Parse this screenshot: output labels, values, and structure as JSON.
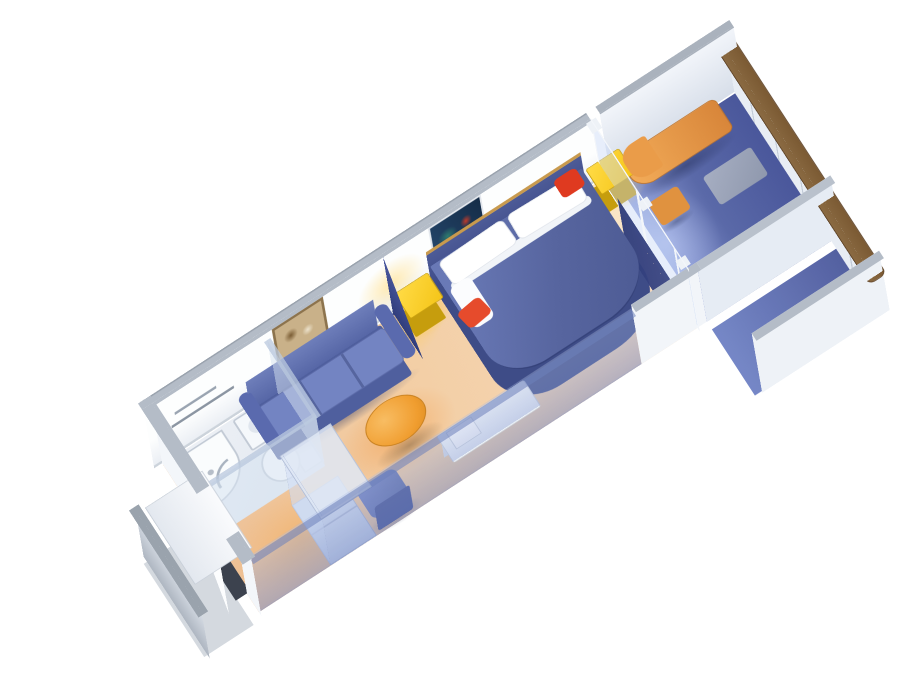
{
  "meta": {
    "scene": "Cruise ship balcony stateroom - 3D isometric cutaway floor plan",
    "view": "isometric cutaway, cabin axis running lower-left to upper-right",
    "background": "#ffffff"
  },
  "palette": {
    "floor": "#f3cfa6",
    "floorGlow": "#f3a55f",
    "wall": "#fdfefe",
    "wallCap": "#b4bcc7",
    "translucentWall": "rgba(125,145,200,0.45)",
    "deck": "#4a579b",
    "deckLight": "#8d9cd8",
    "bedTop": "#57659f",
    "bedBase": "#3e4c87",
    "sofa": "#5d6cab",
    "cushion": "#7384c2",
    "accentYellow": "#f5c519",
    "accentRed": "#e64b2c",
    "tableOrange": "#f09d2f",
    "loungerOrange": "#e0923f",
    "curtain": "#3b4886",
    "railTop": "#7b5a33",
    "bath": "#eef1f6",
    "white": "#ffffff"
  },
  "rooms": {
    "stateroom": "Stateroom",
    "bathroom": "Bathroom",
    "balcony": "Private balcony",
    "entrance": "Entrance vestibule",
    "neighborBalcony": "Adjacent balcony"
  },
  "labels": {
    "bed": "Queen bed with navy spread and rounded foot",
    "pillow": "White pillow",
    "bolster": "White bolster",
    "headboard": "Navy headboard with tan trim",
    "nightstandA": "Yellow nightstand with lamp glow",
    "nightstandB": "Yellow nightstand with lamp glow",
    "cushionA": "Red accent cushion",
    "cushionB": "Red accent cushion",
    "sofa": "Blue three-seat sofa",
    "coffeeTable": "Oval orange coffee table",
    "deskChair": "Blue desk chair",
    "desk": "White vanity desk",
    "tv": "Television on desk",
    "wardrobe": "Wardrobe with sliding doors",
    "floorLamp": "Navy cone decorative lamp",
    "curtain": "Navy privacy curtain",
    "artworkA": "Framed artwork over sofa",
    "artworkB": "Framed artwork over bed",
    "towelBar": "Towel bars",
    "shower": "Shower stall",
    "showerDoor": "Curved shower door",
    "sink": "Washbasin with faucet",
    "toilet": "Toilet",
    "glassDoor": "Sliding glass balcony door",
    "threshold": "Balcony door threshold light",
    "lounger": "Orange balcony lounge chair",
    "sideTable": "Balcony side table",
    "lowTable": "Balcony low table",
    "railing": "Balcony railing panels",
    "railTop": "Wooden railing cap",
    "partitionNW": "Balcony divider panel",
    "partitionSE": "Balcony divider panel",
    "neighborPartition": "Adjacent balcony divider",
    "entryDoor": "Cabin entrance door, ajar",
    "canopy": "Entrance canopy",
    "corridorWall": "Corridor stub wall",
    "nwWall": "Inner cabin wall",
    "seWall": "Translucent corridor-side wall",
    "endWall": "Entrance end wall",
    "bathWall": "Bathroom partition walls",
    "cabinFloor": "Peach stateroom carpet",
    "bathFloor": "Bathroom floor",
    "balconyDeck": "Blue balcony deck"
  }
}
